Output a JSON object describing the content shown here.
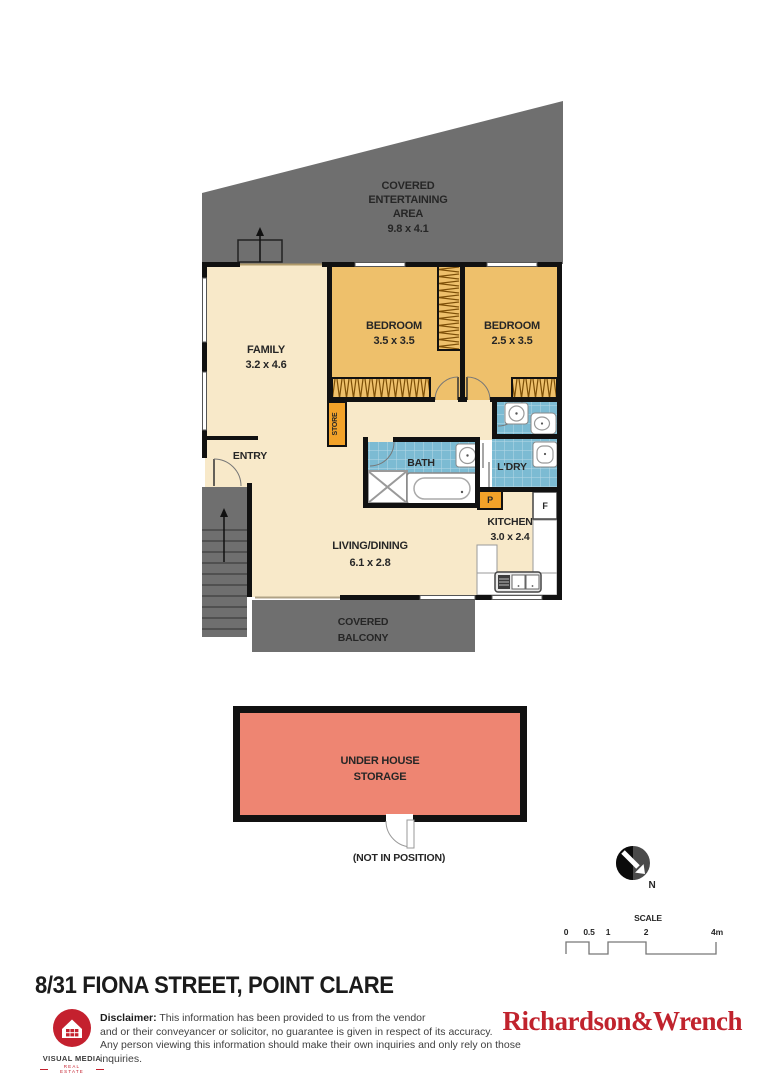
{
  "plan": {
    "entertaining": {
      "lines": [
        "COVERED",
        "ENTERTAINING",
        "AREA",
        "9.8 x 4.1"
      ]
    },
    "family": {
      "name": "FAMILY",
      "dims": "3.2 x 4.6"
    },
    "bedroom1": {
      "name": "BEDROOM",
      "dims": "3.5 x 3.5"
    },
    "bedroom2": {
      "name": "BEDROOM",
      "dims": "2.5 x 3.5"
    },
    "entry": {
      "name": "ENTRY"
    },
    "store": {
      "name": "STORE"
    },
    "bath": {
      "name": "BATH"
    },
    "laundry": {
      "name": "L'DRY"
    },
    "pantry": {
      "name": "P"
    },
    "fridge": {
      "name": "F"
    },
    "kitchen": {
      "name": "KITCHEN",
      "dims": "3.0 x 2.4"
    },
    "living": {
      "name": "LIVING/DINING",
      "dims": "6.1 x 2.8"
    },
    "balcony": {
      "lines": [
        "COVERED",
        "BALCONY"
      ]
    },
    "storage": {
      "lines": [
        "UNDER HOUSE",
        "STORAGE"
      ],
      "note": "(NOT IN POSITION)"
    },
    "compass": {
      "label": "N"
    },
    "scale": {
      "title": "SCALE",
      "ticks": [
        "0",
        "0.5",
        "1",
        "2",
        "4m"
      ]
    }
  },
  "footer": {
    "title": "8/31 FIONA STREET, POINT CLARE",
    "provider": {
      "name": "VISUAL MEDIA",
      "tagline": "REAL ESTATE"
    },
    "disclaimer": {
      "label": "Disclaimer:",
      "text1": " This information has been provided to us from the vendor",
      "text2": "and or their conveyancer or solicitor, no guarantee is given in respect of its accuracy.",
      "text3": "Any person viewing this information should make their own inquiries and only rely on those inquiries."
    },
    "agency": "Richardson&Wrench"
  },
  "colors": {
    "covered_gray": "#6f6f6f",
    "room_cream": "#f8e9c9",
    "room_orange": "#eec06b",
    "tile_blue": "#7cbbd3",
    "cabinet_amber": "#f2a229",
    "storage_salmon": "#ee8572",
    "wall_black": "#111111",
    "brand_red": "#c4202e",
    "agency_red": "#c0232d"
  }
}
